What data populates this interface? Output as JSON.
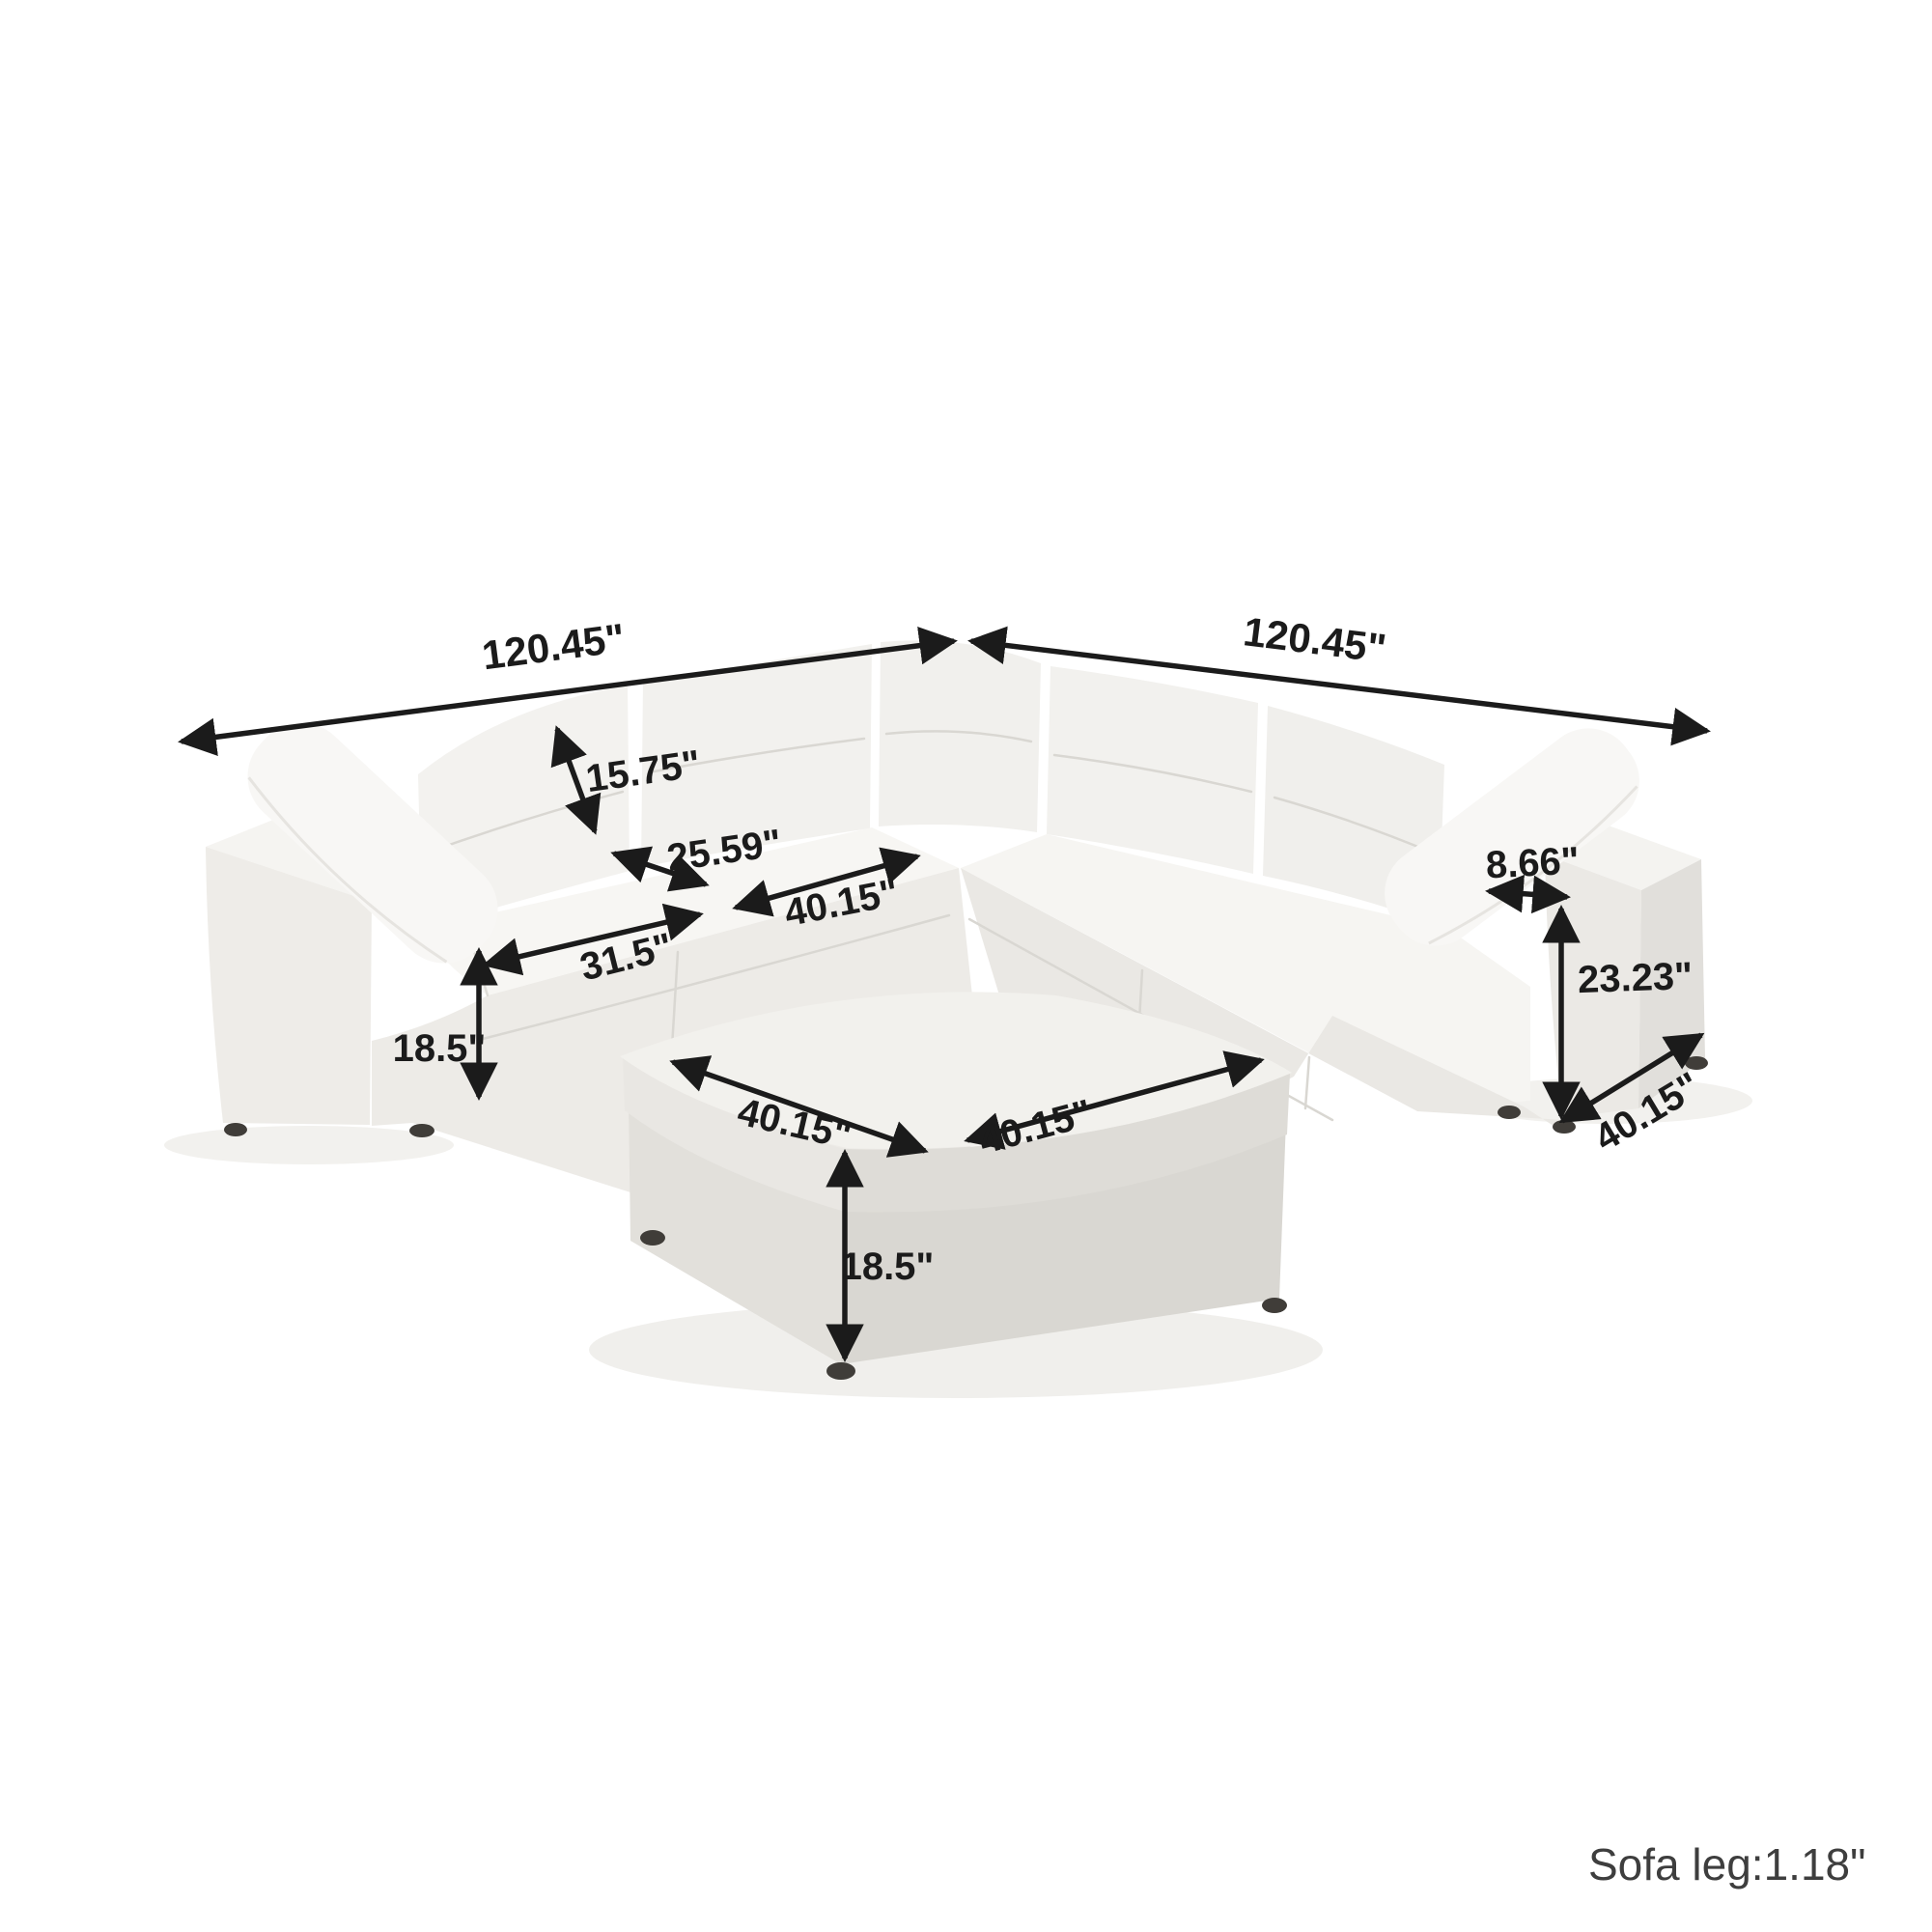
{
  "product": {
    "kind": "modular corner sectional sofa with ottoman",
    "upholstery_color": "white"
  },
  "colors": {
    "background": "#ffffff",
    "dimension_ink": "#1b1b1b",
    "footnote_ink": "#3e3e3e",
    "sofa_light": "#f7f6f3",
    "sofa_mid": "#edebe7",
    "sofa_shadow": "#e1dfdb",
    "leg": "#403d39"
  },
  "dimensions": {
    "back_width_left": "120.45\"",
    "back_width_right": "120.45\"",
    "back_cushion_height": "15.75\"",
    "seat_depth": "25.59\"",
    "corner_seat_width": "40.15\"",
    "seat_width": "31.5\"",
    "base_height": "18.5\"",
    "arm_top_width": "8.66\"",
    "arm_height": "23.23\"",
    "side_depth": "40.15\"",
    "ottoman_front_width": "40.15\"",
    "ottoman_side_width": "40.15\"",
    "ottoman_height": "18.5\""
  },
  "footnote": "Sofa leg:1.18\""
}
